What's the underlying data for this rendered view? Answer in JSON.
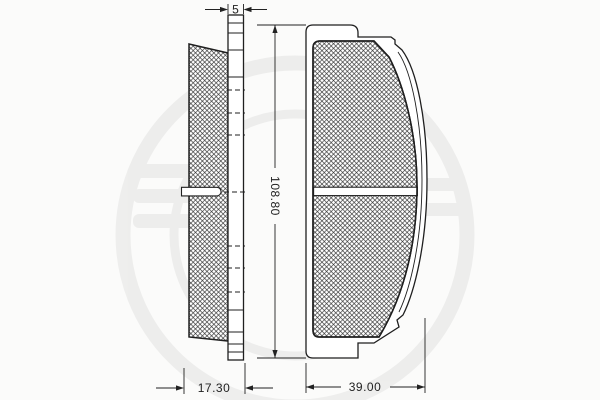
{
  "drawing": {
    "kind": "brake-pad-technical-drawing",
    "dimensions": {
      "plate_thickness": "5",
      "pad_height": "108.80",
      "total_depth": "17.30",
      "pad_width": "39.00"
    },
    "colors": {
      "line": "#1f1f1f",
      "hatch": "#2f2f2f",
      "background": "#fbfbfa",
      "watermark": "#000000"
    }
  }
}
